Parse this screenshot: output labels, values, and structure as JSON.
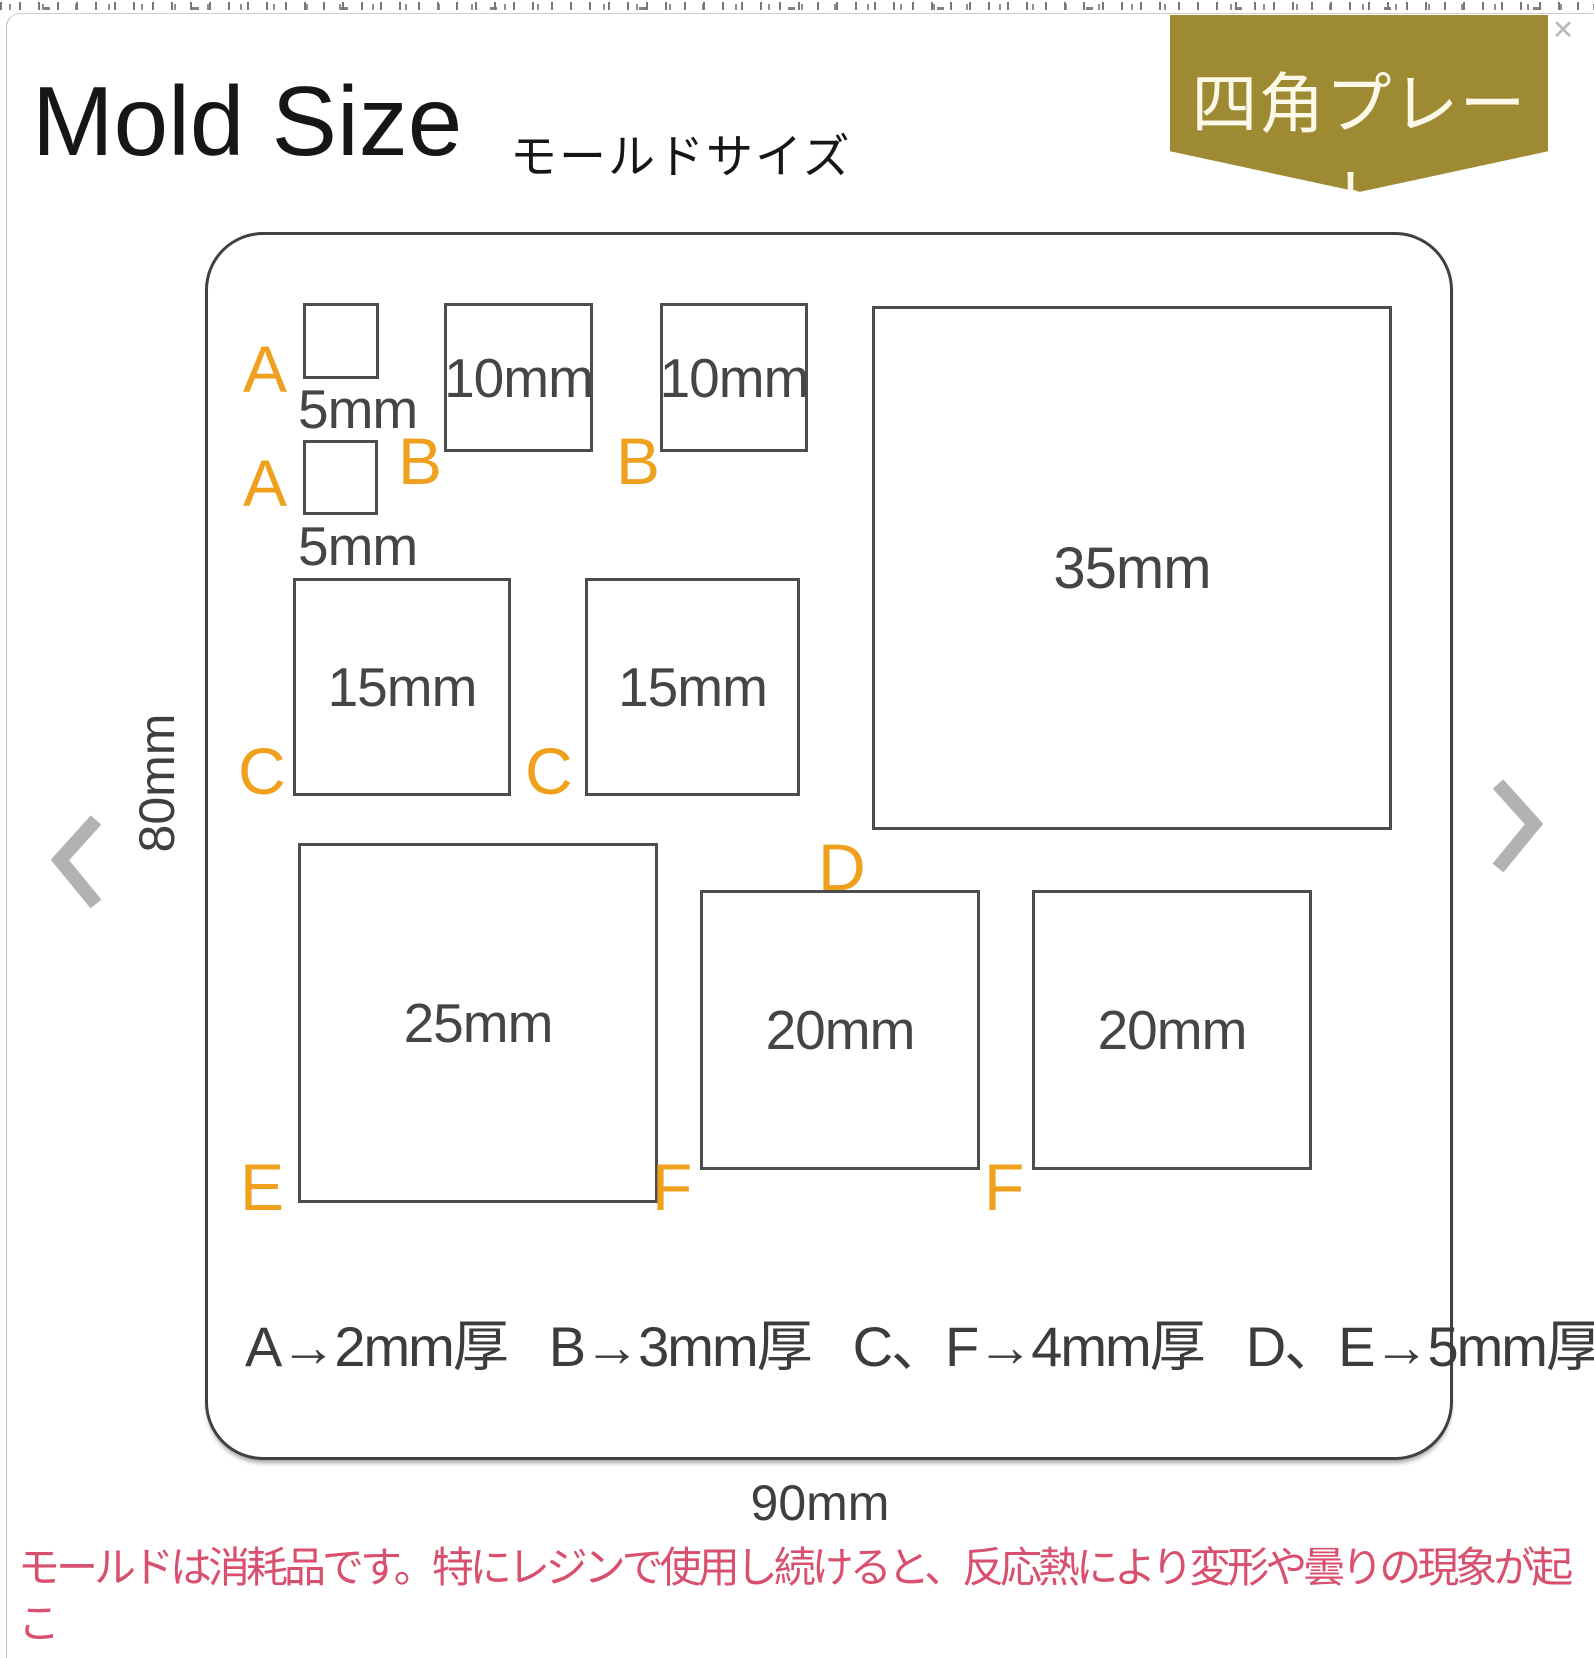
{
  "icons": {
    "close": "✕"
  },
  "header": {
    "title": "Mold Size",
    "subtitle": "モールドサイズ",
    "badge": "四角プレート"
  },
  "diagram": {
    "height_label": "80mm",
    "width_label": "90mm",
    "squares": {
      "a1": {
        "letter": "A",
        "size": "5mm"
      },
      "a2": {
        "letter": "A",
        "size": "5mm"
      },
      "b1": {
        "letter": "B",
        "size": "10mm"
      },
      "b2": {
        "letter": "B",
        "size": "10mm"
      },
      "c1": {
        "letter": "C",
        "size": "15mm"
      },
      "c2": {
        "letter": "C",
        "size": "15mm"
      },
      "d": {
        "letter": "D",
        "size": "35mm"
      },
      "e": {
        "letter": "E",
        "size": "25mm"
      },
      "f1": {
        "letter": "F",
        "size": "20mm"
      },
      "f2": {
        "letter": "F",
        "size": "20mm"
      }
    },
    "thickness_notes": [
      "A→2mm厚",
      "B→3mm厚",
      "C、F→4mm厚",
      "D、E→5mm厚"
    ]
  },
  "footer": {
    "warning_line1": "モールドは消耗品です。特にレジンで使用し続けると、反応熱により変形や曇りの現象が起こ",
    "warning_line2": "る場合があります。硬化後は人肌くらいの温度まで冷ましてから取り出すと長持ちします。"
  },
  "colors": {
    "accent_orange": "#efa11e",
    "badge_gold": "#9d8a33",
    "warning_pink": "#d9506f",
    "outline_gray": "#4d4d4d"
  }
}
